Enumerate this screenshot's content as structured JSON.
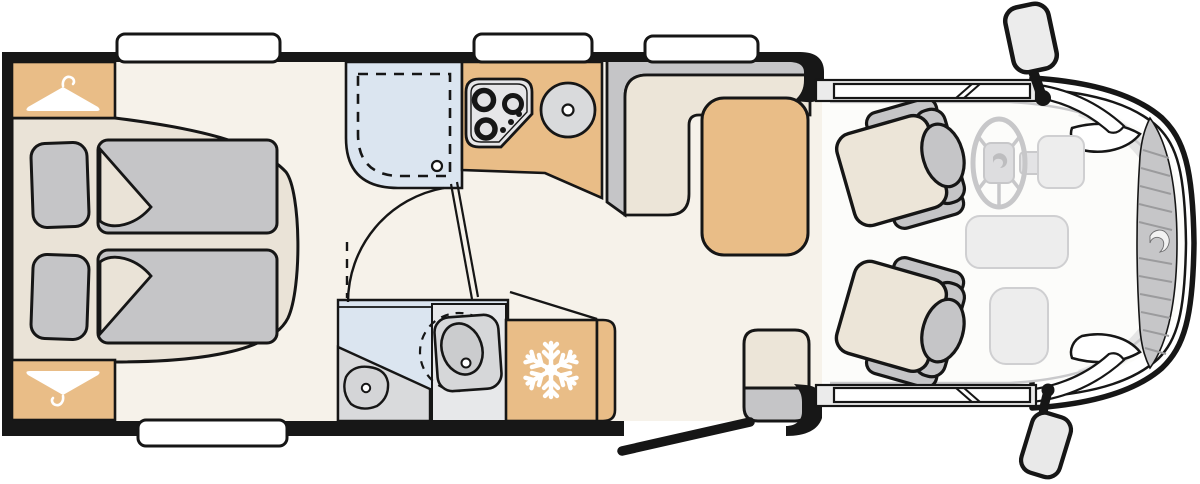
{
  "diagram": {
    "type": "motorhome-floor-plan-top-view",
    "orientation": "cab-front-right-rear-left"
  },
  "colors": {
    "wall": "#171717",
    "outline": "#161616",
    "floor": "#f6f2ea",
    "cab-floor": "#fcfcfa",
    "bed-platform": "#eae3d7",
    "cabinet-tan": "#e9bd87",
    "fabric-gray": "#c5c5c7",
    "cushion-beige": "#ece5d8",
    "water-blue": "#dbe5f0",
    "fixture-gray": "#d9dadc",
    "fixture-light": "#e7e8ea",
    "cab-gray": "#ededed",
    "cab-line": "#c9c9cb",
    "grille-gray": "#c6c6c8",
    "hatch-gray": "#9b9b9d",
    "icon-white": "#ffffff"
  },
  "icons": {
    "wardrobe_top": "clothes-hanger-icon",
    "wardrobe_bottom": "clothes-hanger-icon",
    "refrigerator": "snowflake-icon",
    "grille": "manufacturer-logo-swirl-icon",
    "steering_hub": "manufacturer-logo-swirl-icon"
  },
  "areas": {
    "rear_bedroom": [
      "wardrobe-top",
      "wardrobe-bottom",
      "twin-bed-top",
      "twin-bed-bottom",
      "pillows",
      "duvets"
    ],
    "washroom": [
      "shower-cubicle",
      "shower-drain",
      "swivel-toilet",
      "washbasin",
      "vanity"
    ],
    "kitchen": [
      "three-burner-hob",
      "round-sink",
      "worktop"
    ],
    "refrigerator": [
      "snowflake-icon"
    ],
    "dinette": [
      "l-shaped-bench",
      "table"
    ],
    "entrance": [
      "open-entry-door",
      "bench-step"
    ],
    "cab": [
      "driver-swivel-seat",
      "passenger-swivel-seat",
      "steering-wheel",
      "dashboard",
      "side-mirror-top",
      "side-mirror-bottom",
      "windscreen",
      "front-grille",
      "headlights"
    ]
  },
  "window_counts": {
    "top_wall": 3,
    "bottom_wall": 1,
    "cab_side": 2
  }
}
